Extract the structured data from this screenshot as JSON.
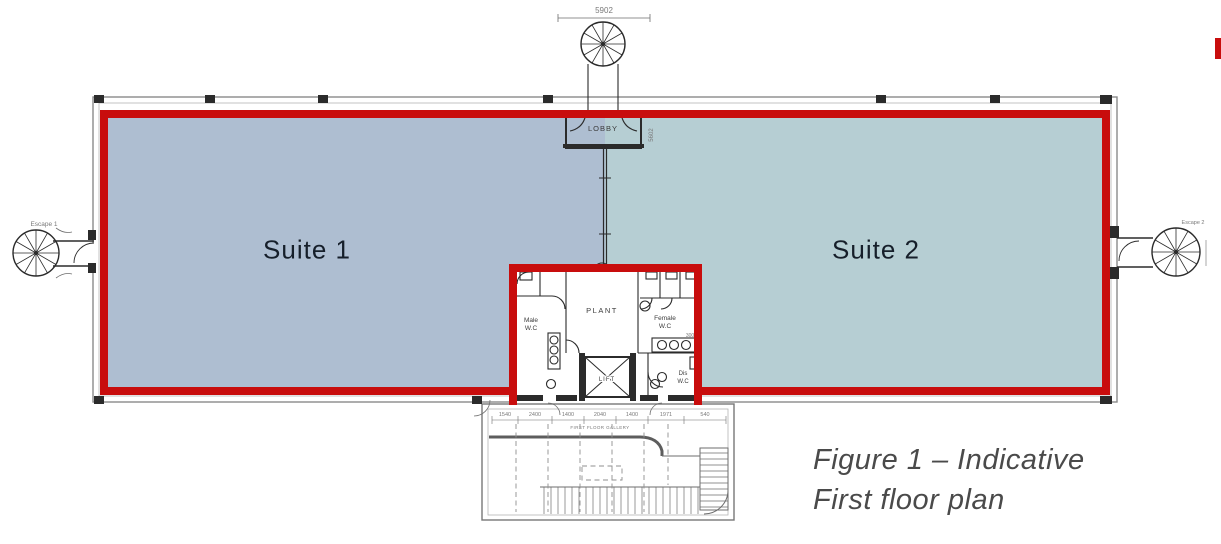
{
  "figure": {
    "caption_line1": "Figure 1 – Indicative",
    "caption_line2": "First floor plan"
  },
  "suites": {
    "suite1": "Suite 1",
    "suite2": "Suite 2"
  },
  "core": {
    "lobby": "LOBBY",
    "plant": "PLANT",
    "male_wc_l1": "Male",
    "male_wc_l2": "W.C",
    "female_wc_l1": "Female",
    "female_wc_l2": "W.C",
    "dis_wc_l1": "Dis",
    "dis_wc_l2": "W.C",
    "lift": "LIFT",
    "dim_300": "300"
  },
  "stairs": {
    "top_dim": "5902",
    "lobby_side_dim": "5602",
    "left_label": "Escape 1",
    "right_label": "Escape 2"
  },
  "gallery": {
    "label": "FIRST FLOOR GALLERY",
    "dims": [
      "1540",
      "2400",
      "1400",
      "2040",
      "1400",
      "1971",
      "540"
    ],
    "dim_540": "540"
  },
  "colors": {
    "outline_red": "#c80d0d",
    "suite1_fill": "#aebed1",
    "suite2_fill": "#b6ced3",
    "plan_dark": "#2b2b2b",
    "plan_gray": "#6e6e6e",
    "caption_text": "#4a4a4a",
    "suite_label_text": "#161f2a"
  }
}
